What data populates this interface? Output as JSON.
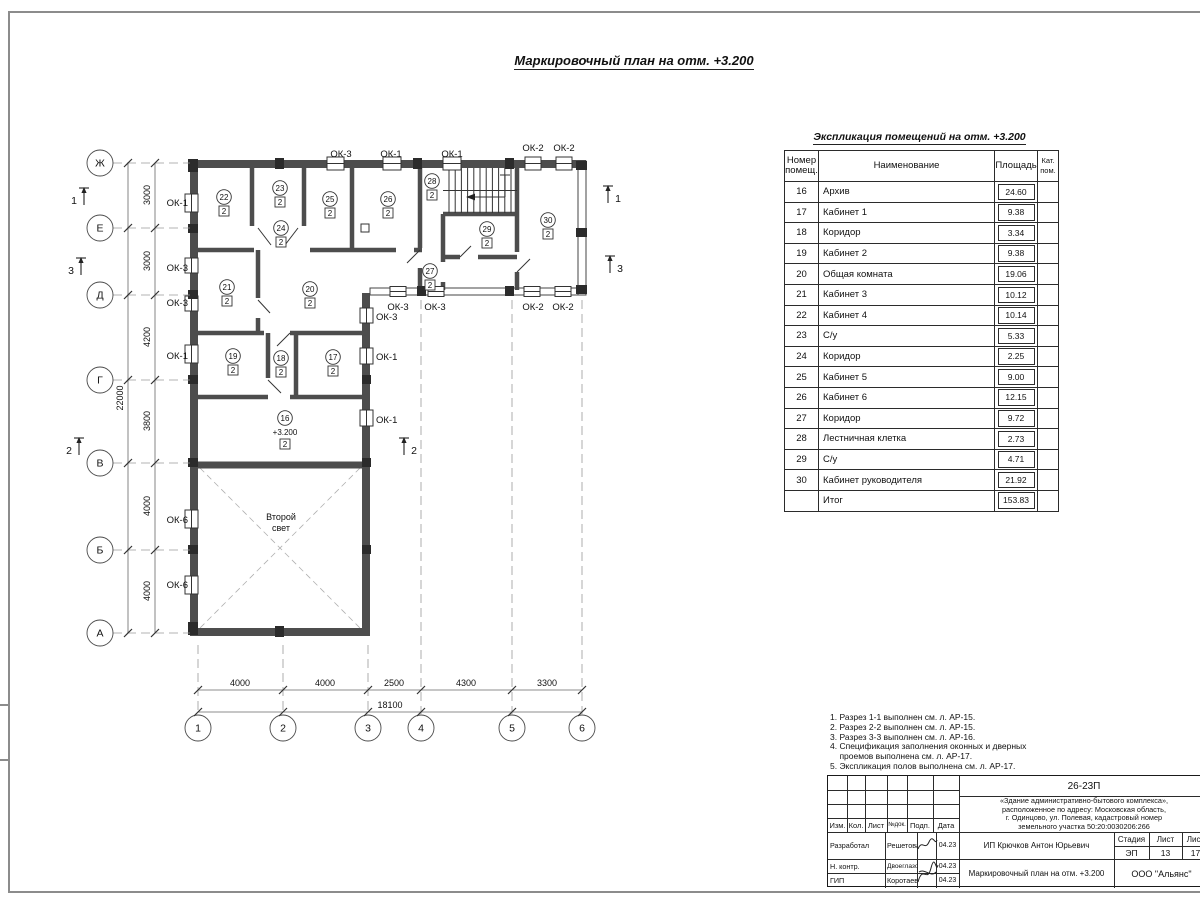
{
  "sheet_title": "Маркировочный план на отм. +3.200",
  "explication": {
    "title": "Экспликация помещений на отм. +3.200",
    "headers": {
      "num": "Номер помещ.",
      "name": "Наименование",
      "area": "Площадь",
      "cat": "Кат. пом."
    },
    "rows": [
      {
        "num": "16",
        "name": "Архив",
        "area": "24.60"
      },
      {
        "num": "17",
        "name": "Кабинет 1",
        "area": "9.38"
      },
      {
        "num": "18",
        "name": "Коридор",
        "area": "3.34"
      },
      {
        "num": "19",
        "name": "Кабинет 2",
        "area": "9.38"
      },
      {
        "num": "20",
        "name": "Общая комната",
        "area": "19.06"
      },
      {
        "num": "21",
        "name": "Кабинет 3",
        "area": "10.12"
      },
      {
        "num": "22",
        "name": "Кабинет 4",
        "area": "10.14"
      },
      {
        "num": "23",
        "name": "С/у",
        "area": "5.33"
      },
      {
        "num": "24",
        "name": "Коридор",
        "area": "2.25"
      },
      {
        "num": "25",
        "name": "Кабинет 5",
        "area": "9.00"
      },
      {
        "num": "26",
        "name": "Кабинет 6",
        "area": "12.15"
      },
      {
        "num": "27",
        "name": "Коридор",
        "area": "9.72"
      },
      {
        "num": "28",
        "name": "Лестничная клетка",
        "area": "2.73"
      },
      {
        "num": "29",
        "name": "С/у",
        "area": "4.71"
      },
      {
        "num": "30",
        "name": "Кабинет руководителя",
        "area": "21.92"
      }
    ],
    "total": {
      "num": "",
      "name": "Итог",
      "area": "153.83"
    }
  },
  "plan": {
    "row_axes": [
      {
        "label": "Ж",
        "y": 163
      },
      {
        "label": "Е",
        "y": 228
      },
      {
        "label": "Д",
        "y": 295
      },
      {
        "label": "Г",
        "y": 380
      },
      {
        "label": "В",
        "y": 463
      },
      {
        "label": "Б",
        "y": 550
      },
      {
        "label": "А",
        "y": 633
      }
    ],
    "col_axes": [
      {
        "label": "1",
        "x": 198,
        "dash_from": 645
      },
      {
        "label": "2",
        "x": 283,
        "dash_from": 645
      },
      {
        "label": "3",
        "x": 368,
        "dash_from": 645
      },
      {
        "label": "4",
        "x": 421,
        "dash_from": 300
      },
      {
        "label": "5",
        "x": 512,
        "dash_from": 300
      },
      {
        "label": "6",
        "x": 582,
        "dash_from": 300
      }
    ],
    "dims_left": [
      {
        "t": "3000",
        "y": 195
      },
      {
        "t": "3000",
        "y": 261
      },
      {
        "t": "4200",
        "y": 337
      },
      {
        "t": "3800",
        "y": 421
      },
      {
        "t": "4000",
        "y": 506
      },
      {
        "t": "4000",
        "y": 591
      }
    ],
    "dim_left_total": "22000",
    "dims_bottom": [
      {
        "t": "4000",
        "x": 240
      },
      {
        "t": "4000",
        "x": 325
      },
      {
        "t": "2500",
        "x": 394
      },
      {
        "t": "4300",
        "x": 466
      },
      {
        "t": "3300",
        "x": 547
      }
    ],
    "dim_bottom_total": "18100",
    "rooms": [
      {
        "num": "22",
        "cat": "2",
        "x": 224,
        "y": 197
      },
      {
        "num": "23",
        "cat": "2",
        "x": 280,
        "y": 188
      },
      {
        "num": "24",
        "cat": "2",
        "x": 281,
        "y": 228
      },
      {
        "num": "25",
        "cat": "2",
        "x": 330,
        "y": 199
      },
      {
        "num": "26",
        "cat": "2",
        "x": 388,
        "y": 199
      },
      {
        "num": "28",
        "cat": "2",
        "x": 432,
        "y": 181
      },
      {
        "num": "29",
        "cat": "2",
        "x": 487,
        "y": 229
      },
      {
        "num": "30",
        "cat": "2",
        "x": 548,
        "y": 220
      },
      {
        "num": "21",
        "cat": "2",
        "x": 227,
        "y": 287
      },
      {
        "num": "20",
        "cat": "2",
        "x": 310,
        "y": 289
      },
      {
        "num": "27",
        "cat": "2",
        "x": 430,
        "y": 271
      },
      {
        "num": "19",
        "cat": "2",
        "x": 233,
        "y": 356
      },
      {
        "num": "18",
        "cat": "2",
        "x": 281,
        "y": 358
      },
      {
        "num": "17",
        "cat": "2",
        "x": 333,
        "y": 357
      },
      {
        "num": "16",
        "cat": "2",
        "x": 285,
        "y": 418,
        "level": "+3.200"
      }
    ],
    "window_labels": [
      {
        "t": "ОК-1",
        "x": 188,
        "y": 206,
        "a": "e"
      },
      {
        "t": "ОК-3",
        "x": 188,
        "y": 271,
        "a": "e"
      },
      {
        "t": "ОК-3",
        "x": 188,
        "y": 306,
        "a": "e"
      },
      {
        "t": "ОК-1",
        "x": 188,
        "y": 359,
        "a": "e"
      },
      {
        "t": "ОК-6",
        "x": 188,
        "y": 523,
        "a": "e"
      },
      {
        "t": "ОК-6",
        "x": 188,
        "y": 588,
        "a": "e"
      },
      {
        "t": "ОК-3",
        "x": 341,
        "y": 157,
        "a": "m"
      },
      {
        "t": "ОК-1",
        "x": 391,
        "y": 157,
        "a": "m"
      },
      {
        "t": "ОК-1",
        "x": 452,
        "y": 157,
        "a": "m"
      },
      {
        "t": "ОК-2",
        "x": 533,
        "y": 151,
        "a": "m"
      },
      {
        "t": "ОК-2",
        "x": 564,
        "y": 151,
        "a": "m"
      },
      {
        "t": "ОК-3",
        "x": 398,
        "y": 310,
        "a": "m"
      },
      {
        "t": "ОК-3",
        "x": 435,
        "y": 310,
        "a": "m"
      },
      {
        "t": "ОК-2",
        "x": 533,
        "y": 310,
        "a": "m"
      },
      {
        "t": "ОК-2",
        "x": 563,
        "y": 310,
        "a": "m"
      },
      {
        "t": "ОК-3",
        "x": 376,
        "y": 320,
        "a": "s"
      },
      {
        "t": "ОК-1",
        "x": 376,
        "y": 360,
        "a": "s"
      },
      {
        "t": "ОК-1",
        "x": 376,
        "y": 423,
        "a": "s"
      }
    ],
    "sections": [
      {
        "n": "1",
        "x": 84,
        "y": 196,
        "side": -1
      },
      {
        "n": "3",
        "x": 81,
        "y": 266,
        "side": -1
      },
      {
        "n": "2",
        "x": 79,
        "y": 446,
        "side": -1
      },
      {
        "n": "1",
        "x": 608,
        "y": 194,
        "side": 1
      },
      {
        "n": "3",
        "x": 610,
        "y": 264,
        "side": 1
      },
      {
        "n": "2",
        "x": 404,
        "y": 446,
        "side": 1
      }
    ],
    "void_label_lines": [
      "Второй",
      "свет"
    ],
    "void_label_pos": {
      "x": 281,
      "y": 520
    }
  },
  "notes": {
    "lines": [
      "1. Разрез 1-1 выполнен см. л. АР-15.",
      "2. Разрез 2-2 выполнен см. л. АР-15.",
      "3. Разрез 3-3 выполнен см. л. АР-16.",
      "4. Спецификация заполнения оконных и дверных",
      "    проемов выполнена см. л. АР-17.",
      "5. Экспликация полов выполнена см. л. АР-17."
    ]
  },
  "titleblock": {
    "doc_number": "26-23П",
    "project_lines": [
      "«Здание административно-бытового комплекса»,",
      "расположенное по адресу: Московская область,",
      "г. Одинцово, ул. Полевая, кадастровый номер",
      "земельного участка 50:20:0030206:266"
    ],
    "client": "ИП Крючков Антон Юрьевич",
    "drawing_title": "Маркировочный план на отм. +3.200",
    "company": "ООО \"Альянс\"",
    "stage_label": "Стадия",
    "sheet_label": "Лист",
    "sheets_label": "Лист",
    "stage": "ЭП",
    "sheet_no": "13",
    "sheets_total": "17",
    "header_cols": [
      "Изм.",
      "Кол.",
      "Лист",
      "№док.",
      "Подп.",
      "Дата"
    ],
    "sign_rows": [
      {
        "role": "Разработал",
        "name": "Решетова",
        "date": "04.23"
      },
      {
        "role": "Н. контр.",
        "name": "Двоеглазов",
        "date": "04.23"
      },
      {
        "role": "ГИП",
        "name": "Коротаев",
        "date": "04.23"
      }
    ]
  }
}
